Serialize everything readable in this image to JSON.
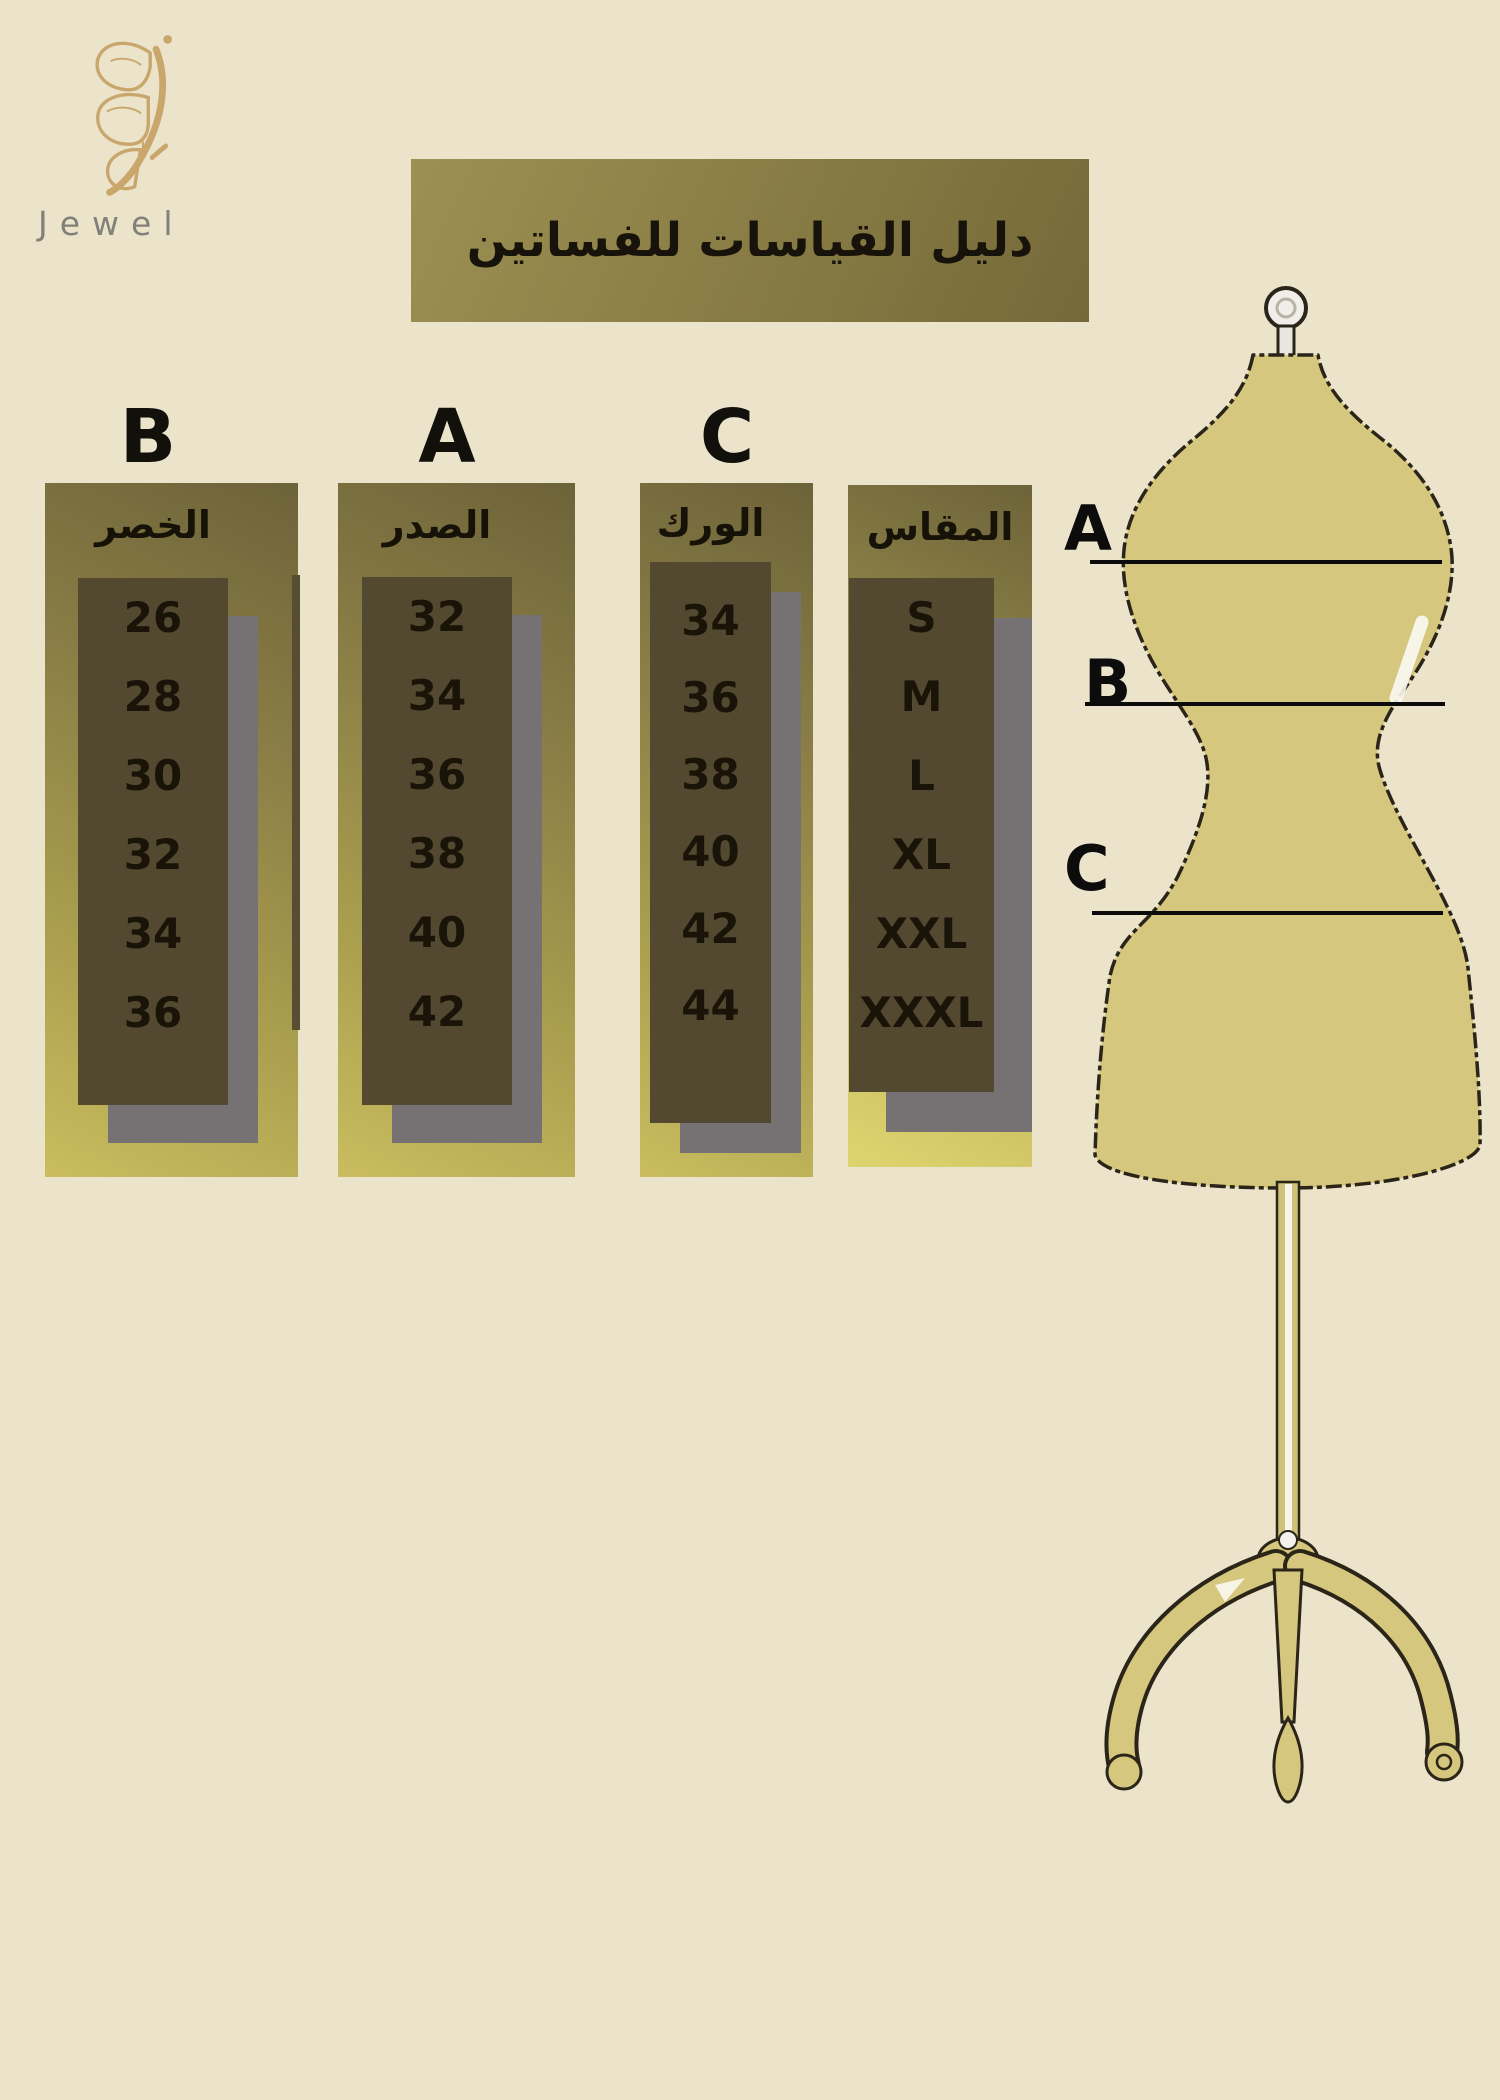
{
  "logo": {
    "brand": "Jewel"
  },
  "title": {
    "text": "دليل القياسات للفساتين"
  },
  "size_chart": {
    "columns": [
      {
        "letter": "B",
        "header": "الخصر",
        "values": [
          "26",
          "28",
          "30",
          "32",
          "34",
          "36"
        ]
      },
      {
        "letter": "A",
        "header": "الصدر",
        "values": [
          "32",
          "34",
          "36",
          "38",
          "40",
          "42"
        ]
      },
      {
        "letter": "C",
        "header": "الورك",
        "values": [
          "34",
          "36",
          "38",
          "40",
          "42",
          "44"
        ]
      },
      {
        "letter": "",
        "header": "المقاس",
        "values": [
          "S",
          "M",
          "L",
          "XL",
          "XXL",
          "XXXL"
        ]
      }
    ]
  },
  "mannequin": {
    "label_a": "A",
    "label_b": "B",
    "label_c": "C"
  },
  "colors": {
    "background": "#ebe4cb",
    "panel_olive": "#8d8147",
    "panel_yellow_bottom": "#ded46f",
    "cell_dark_brown": "#534931",
    "shadow_gray": "#767172",
    "banner_olive": "#877b44",
    "mannequin_fill": "#d5c77d",
    "outline_dark": "#2a2518",
    "logo_gold": "#c9a76c",
    "brand_gray": "#81817a",
    "text_dark": "#17130a"
  },
  "chart_data": {
    "type": "table",
    "title": "دليل القياسات للفساتين",
    "column_headers": [
      "B الخصر",
      "A الصدر",
      "C الورك",
      "المقاس"
    ],
    "rows": [
      {
        "size": "S",
        "bust_A": 32,
        "waist_B": 26,
        "hip_C": 34
      },
      {
        "size": "M",
        "bust_A": 34,
        "waist_B": 28,
        "hip_C": 36
      },
      {
        "size": "L",
        "bust_A": 36,
        "waist_B": 30,
        "hip_C": 38
      },
      {
        "size": "XL",
        "bust_A": 38,
        "waist_B": 32,
        "hip_C": 40
      },
      {
        "size": "XXL",
        "bust_A": 40,
        "waist_B": 34,
        "hip_C": 42
      },
      {
        "size": "XXXL",
        "bust_A": 42,
        "waist_B": 36,
        "hip_C": 44
      }
    ],
    "notes": "Dress form diagram at right with measurement lines A (bust), B (waist), C (hip)"
  }
}
